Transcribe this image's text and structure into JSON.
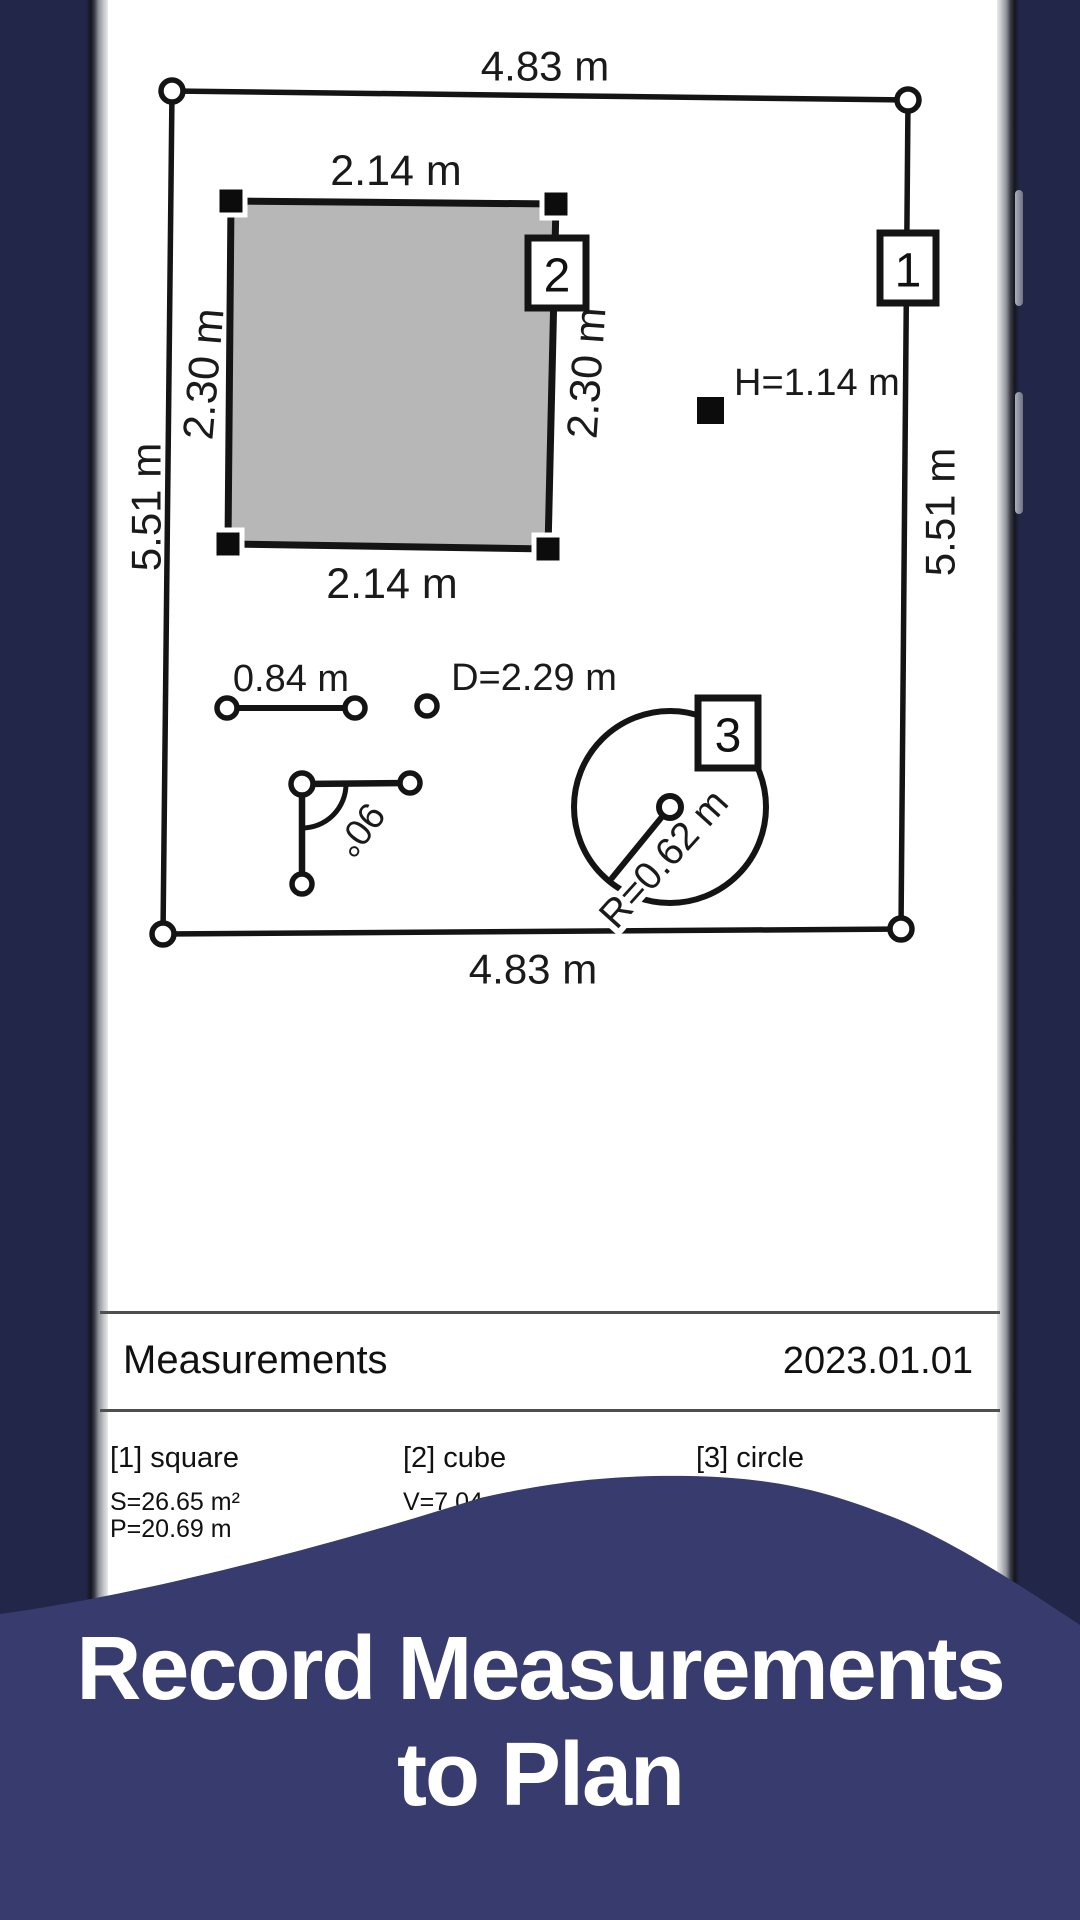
{
  "plan": {
    "outer": {
      "width_top": "4.83 m",
      "width_bottom": "4.83 m",
      "height_left": "5.51 m",
      "height_right": "5.51 m",
      "tag": "1"
    },
    "room": {
      "width_top": "2.14 m",
      "width_bottom": "2.14 m",
      "height_left": "2.30 m",
      "height_right": "2.30 m",
      "tag": "2"
    },
    "height_note": {
      "text": "H=1.14 m"
    },
    "segment": {
      "length": "0.84 m"
    },
    "diameter": {
      "text": "D=2.29 m"
    },
    "angle": {
      "text": "90°"
    },
    "circle": {
      "radius": "R=0.62 m",
      "tag": "3"
    }
  },
  "report": {
    "title": "Measurements",
    "date": "2023.01.01",
    "items": [
      {
        "label": "[1] square",
        "line1": "S=26.65 m²",
        "line2": "P=20.69 m"
      },
      {
        "label": "[2] cube",
        "line1": "V=7.04 m³",
        "line2": ""
      },
      {
        "label": "[3] circle",
        "line1": "",
        "line2": ""
      }
    ]
  },
  "caption": {
    "line1": "Record Measurements",
    "line2": "to Plan"
  },
  "colors": {
    "background": "#222648",
    "wave": "#373b6d",
    "ink": "#141414",
    "room_fill": "#b7b7b7",
    "caption_text": "#ffffff"
  }
}
